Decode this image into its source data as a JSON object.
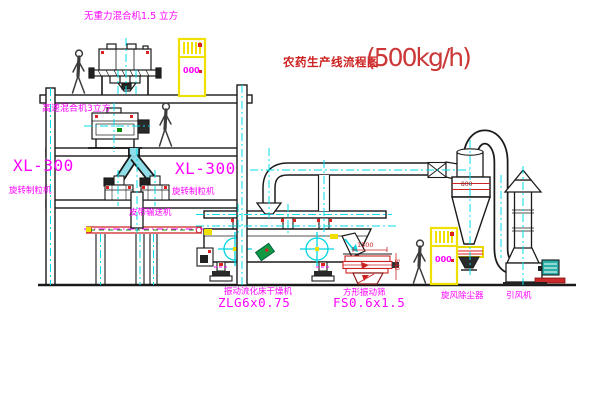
{
  "title": {
    "text": "农药生产线流程图",
    "capacity": "(500kg/h)"
  },
  "labels": {
    "gravity_free_mixer": "无重力混合机1.5 立方",
    "high_speed_mixer": "高速混合机3立方",
    "granulator_left": {
      "model": "XL-300",
      "name": "旋转制粒机"
    },
    "granulator_right": {
      "model": "XL-300",
      "name": "旋转制粒机"
    },
    "belt_conveyor": "皮带输送机",
    "dryer": {
      "name": "振动流化床干燥机",
      "model": "ZLG6x0.75"
    },
    "sieve": {
      "name": "方形振动筛",
      "model": "FS0.6x1.5"
    },
    "cyclone": "旋风除尘器",
    "fan": "引风机"
  },
  "dimensions": {
    "sieve_length": "1500",
    "cyclone_diameter": "800",
    "sieve_height": "540"
  },
  "cabinets": [
    {
      "display": "000"
    },
    {
      "display": "000"
    }
  ],
  "colors": {
    "line": "#1a1a1a",
    "centerline": "#00dde6",
    "label": "#ff00ff",
    "title_red": "#cc2020",
    "machine_red": "#cc2222",
    "highlight_yellow": "#f0e000",
    "chute_cyan": "#8fdde8",
    "motor_teal": "#2ab0a8",
    "green": "#0a9a0a"
  }
}
